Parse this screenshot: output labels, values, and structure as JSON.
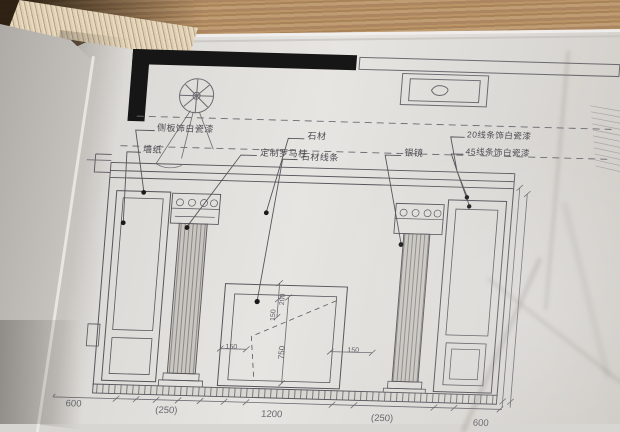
{
  "callouts": {
    "panel_finish": "侧板饰白瓷漆",
    "wallpaper": "墙纸",
    "roman_column": "定制罗马柱",
    "stone": "石材",
    "stone_molding": "石材线条",
    "mirror": "银镜",
    "molding_20": "20线条饰白瓷漆",
    "molding_45": "45线条饰白瓷漆"
  },
  "dimensions": {
    "overall_height": "2800",
    "inner_height": "2400",
    "top_band": "400",
    "niche_top": "200",
    "niche_ledge": "150",
    "niche_height": "750",
    "niche_left": "150",
    "niche_right": "150",
    "bottom": [
      "600",
      "(250)",
      "1200",
      "(250)",
      "600"
    ]
  },
  "colors": {
    "wood": "#ab8558",
    "paper": "#dedcd8",
    "ink": "#55545a",
    "wall_fill": "#161616"
  }
}
